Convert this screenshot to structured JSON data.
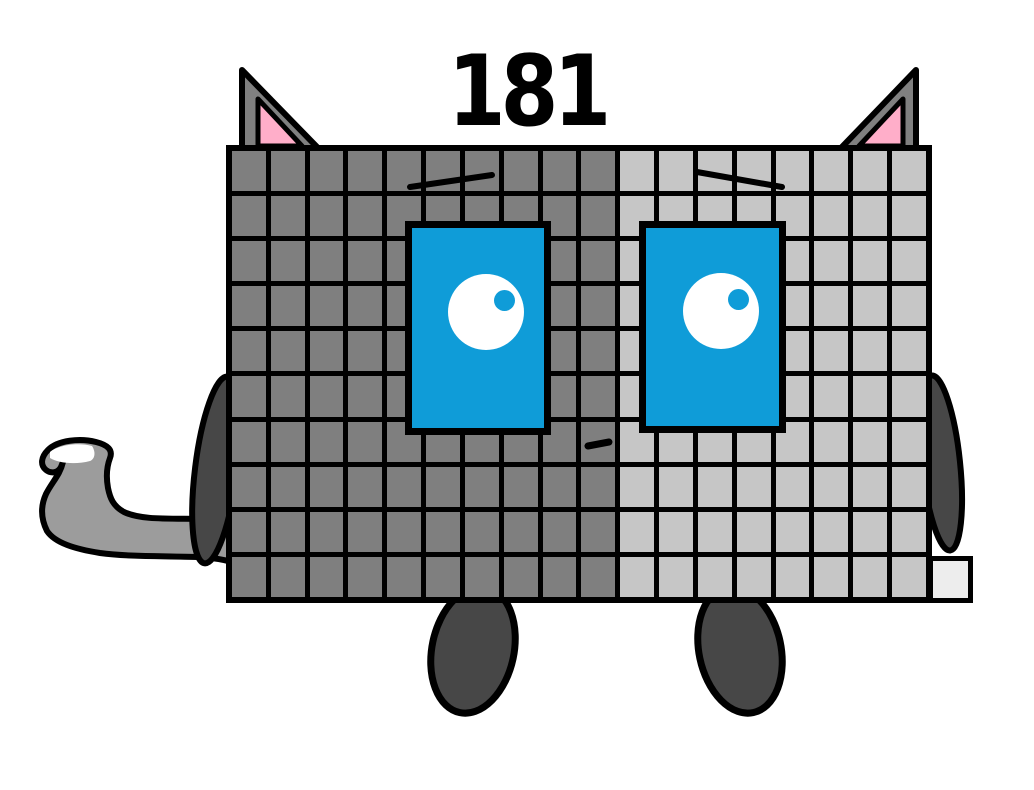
{
  "title": {
    "number": "181"
  },
  "figure": {
    "alt": "Cartoon cat-shaped character built from a grid of square blocks, labeled 181",
    "grid": {
      "columns": 18,
      "rows": 10,
      "dark_columns": 10,
      "light_columns": 8,
      "extra_blocks": 1,
      "total_blocks": 181
    },
    "colors": {
      "background": "#ffffff",
      "outline": "#000000",
      "numeral": "#000000",
      "dark_block": "#7f7f7f",
      "light_block": "#c6c6c6",
      "extra_block": "#ededed",
      "eye_blue": "#0f9cd8",
      "eye_white": "#ffffff",
      "ear_pink": "#ffaec9",
      "ear_gray": "#808080",
      "limb_dark": "#474747",
      "tail_gray": "#9c9c9c",
      "tail_tip": "#ffffff"
    }
  }
}
